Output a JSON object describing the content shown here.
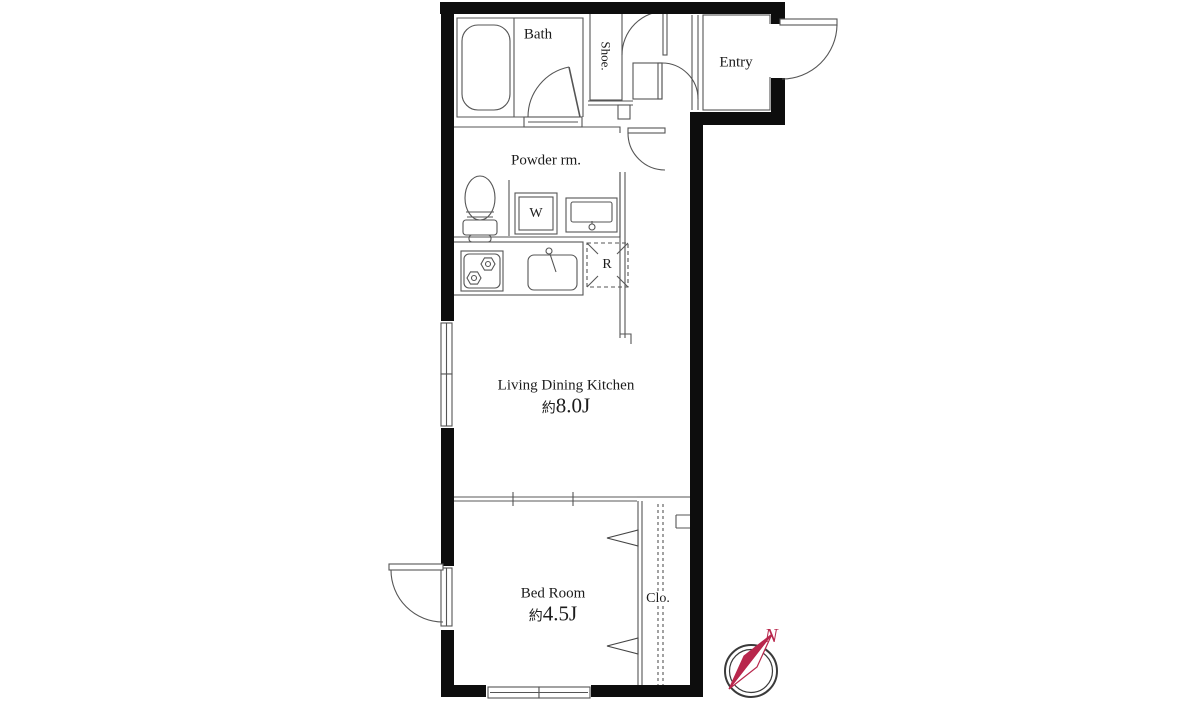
{
  "plan": {
    "rooms": {
      "bath": {
        "label": "Bath"
      },
      "shoe": {
        "label": "Shoe."
      },
      "entry": {
        "label": "Entry"
      },
      "powder": {
        "label": "Powder rm."
      },
      "washer": {
        "label": "W"
      },
      "fridge": {
        "label": "R"
      },
      "ldk": {
        "label": "Living Dining Kitchen",
        "size_prefix": "約",
        "size_value": "8.0J"
      },
      "bedroom": {
        "label": "Bed Room",
        "size_prefix": "約",
        "size_value": "4.5J"
      },
      "closet": {
        "label": "Clo."
      }
    },
    "compass": {
      "north_label": "N"
    },
    "colors": {
      "wall": "#0d0d0d",
      "line": "#555555",
      "divider": "#909090",
      "accent": "#b8274c"
    }
  }
}
